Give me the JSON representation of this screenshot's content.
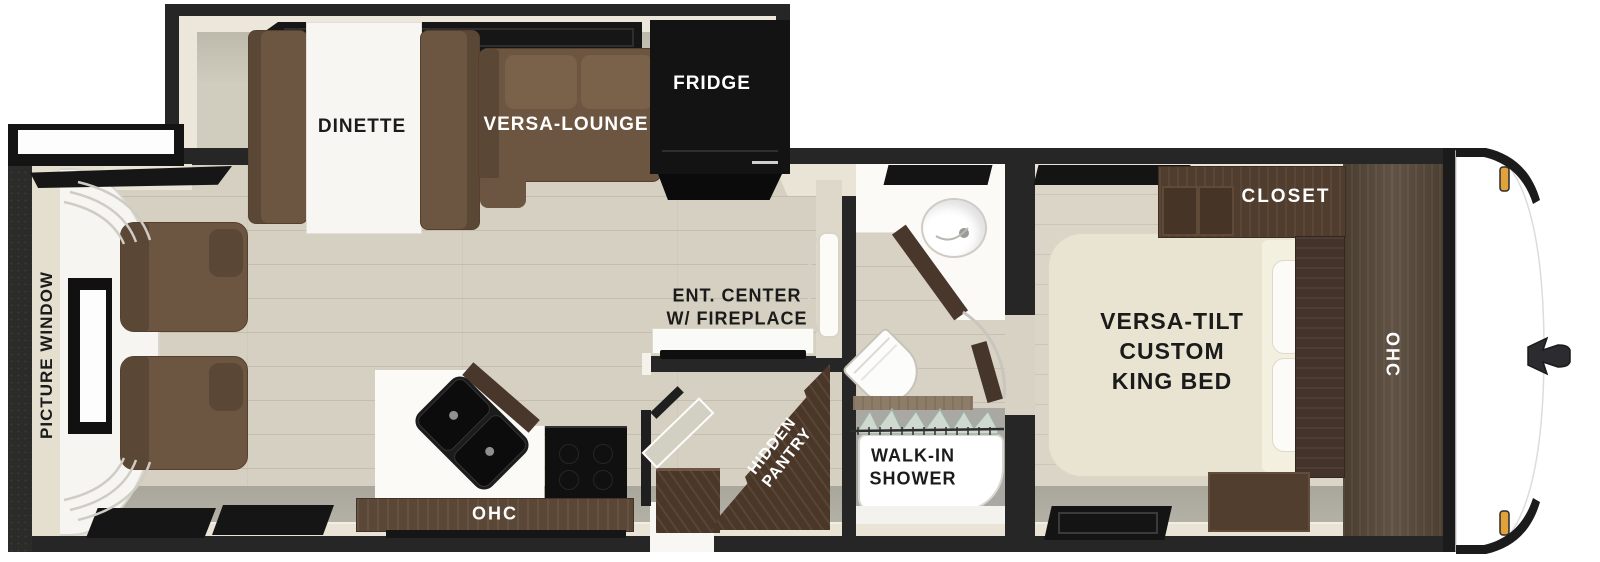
{
  "title": "Travel trailer floor plan",
  "labels": {
    "dinette": "DINETTE",
    "versa_lounge": "VERSA-LOUNGE",
    "fridge": "FRIDGE",
    "picture_window": "PICTURE WINDOW",
    "ent_center": [
      "ENT. CENTER",
      "W/ FIREPLACE"
    ],
    "kitchen_ohc": "OHC",
    "hidden_pantry": [
      "HIDDEN",
      "PANTRY"
    ],
    "walk_in_shower": [
      "WALK-IN",
      "SHOWER"
    ],
    "closet": "CLOSET",
    "king_bed": [
      "VERSA-TILT",
      "CUSTOM",
      "KING BED"
    ],
    "bedroom_ohc": "OHC"
  },
  "colors": {
    "wall": "#262626",
    "furniture_brown": "#6d5641",
    "dark_wood": "#4a3728",
    "bed_cream": "#e9e4d1",
    "floor_wood": "#d5d0c2",
    "counter_white": "#fbfaf7",
    "appliance_black": "#141414",
    "marker_light": "#e2a23b"
  }
}
